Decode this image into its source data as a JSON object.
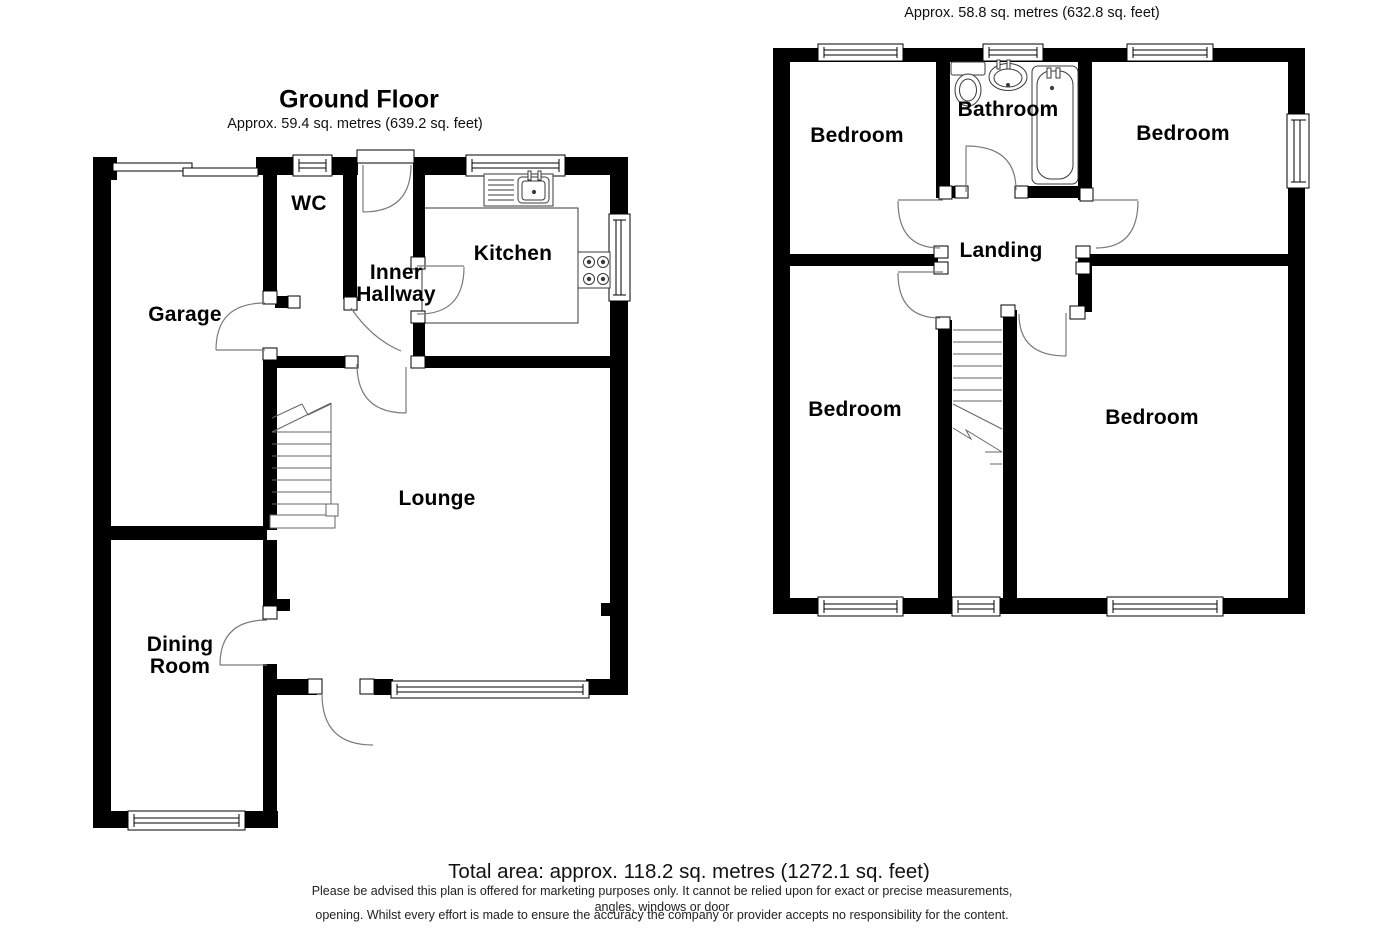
{
  "ground_floor": {
    "title": "Ground Floor",
    "area_label": "Approx. 59.4 sq. metres (639.2 sq. feet)",
    "rooms": {
      "garage": "Garage",
      "wc": "WC",
      "inner_hallway": "Inner\nHallway",
      "kitchen": "Kitchen",
      "lounge": "Lounge",
      "dining_room": "Dining\nRoom"
    }
  },
  "first_floor": {
    "area_label": "Approx. 58.8 sq. metres (632.8 sq. feet)",
    "rooms": {
      "bedroom_top_left": "Bedroom",
      "bathroom": "Bathroom",
      "bedroom_top_right": "Bedroom",
      "landing": "Landing",
      "bedroom_bottom_left": "Bedroom",
      "bedroom_bottom_right": "Bedroom"
    }
  },
  "footer": {
    "total_area": "Total area: approx. 118.2 sq. metres (1272.1 sq. feet)",
    "disclaimer_line1": "Please be advised this plan is offered for marketing purposes only. It cannot be relied upon for exact or precise measurements, angles, windows or door",
    "disclaimer_line2": "opening. Whilst every effort is made to ensure the accuracy the company or provider accepts no responsibility for the content."
  },
  "colors": {
    "wall": "#000000",
    "door_arc": "#7a7a7a",
    "stair": "#666666",
    "fixture": "#3a3a3a"
  }
}
